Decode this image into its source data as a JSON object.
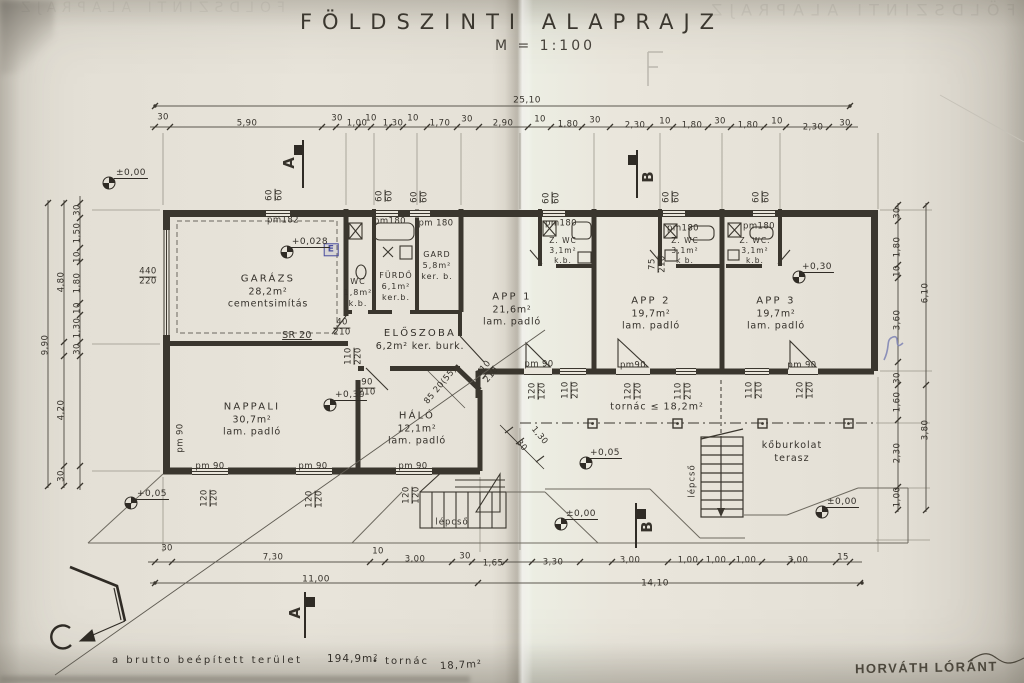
{
  "title": {
    "main": "FÖLDSZINTI ALAPRAJZ",
    "scale": "M = 1:100"
  },
  "footer": {
    "label": "a brutto beépített terület",
    "built_area": "194,9m²",
    "connector": "• tornác",
    "porch_area": "18,7m²",
    "signature": "HORVÁTH LÓRÁNT"
  },
  "rooms": [
    {
      "lines": [
        "GARÁZS",
        "28,2m²",
        "cementsimítás"
      ],
      "x": 268,
      "y": 292
    },
    {
      "lines": [
        "NAPPALI",
        "30,7m²",
        "lam. padló"
      ],
      "x": 252,
      "y": 420
    },
    {
      "lines": [
        "HÁLÓ",
        "12,1m²",
        "lam. padló"
      ],
      "x": 417,
      "y": 429
    },
    {
      "lines": [
        "ELŐSZOBA",
        "6,2m² ker. burk."
      ],
      "x": 420,
      "y": 340
    },
    {
      "lines": [
        "WC",
        "1,8m²",
        "k.b."
      ],
      "x": 358,
      "y": 293,
      "s": 8
    },
    {
      "lines": [
        "FÜRDŐ",
        "6,1m²",
        "ker.b."
      ],
      "x": 396,
      "y": 287,
      "s": 8
    },
    {
      "lines": [
        "GARD",
        "5,8m²",
        "ker. b."
      ],
      "x": 437,
      "y": 266,
      "s": 8
    },
    {
      "lines": [
        "APP 1",
        "21,6m²",
        "lam. padló"
      ],
      "x": 512,
      "y": 310
    },
    {
      "lines": [
        "APP 2",
        "19,7m²",
        "lam. padló"
      ],
      "x": 651,
      "y": 314
    },
    {
      "lines": [
        "APP 3",
        "19,7m²",
        "lam. padló"
      ],
      "x": 776,
      "y": 314
    },
    {
      "lines": [
        "Z. WC",
        "3,1m²",
        "k.b."
      ],
      "x": 563,
      "y": 251,
      "s": 7.5
    },
    {
      "lines": [
        "Z. WC",
        "3,1m²",
        "k b."
      ],
      "x": 685,
      "y": 251,
      "s": 7.5
    },
    {
      "lines": [
        "Z. WC.",
        "3,1m²",
        "k.b."
      ],
      "x": 755,
      "y": 251,
      "s": 7.5
    },
    {
      "lines": [
        "tornác ≤ 18,2m²"
      ],
      "x": 657,
      "y": 408,
      "s": 9.5
    },
    {
      "lines": [
        "kőburkolat",
        "terasz"
      ],
      "x": 792,
      "y": 453,
      "s": 9.5
    },
    {
      "lines": [
        "lépcső"
      ],
      "x": 452,
      "y": 523,
      "s": 8.5
    },
    {
      "lines": [
        "lépcső"
      ],
      "x": 693,
      "y": 481,
      "s": 8.5,
      "r": -90
    }
  ],
  "levels": [
    {
      "t": "±0,00",
      "cx": 109,
      "cy": 183,
      "tx": 131,
      "ty": 179
    },
    {
      "t": "+0,028",
      "cx": 287,
      "cy": 252,
      "tx": 310,
      "ty": 248
    },
    {
      "t": "+0,30",
      "cx": 330,
      "cy": 405,
      "tx": 350,
      "ty": 401
    },
    {
      "t": "+0,30",
      "cx": 799,
      "cy": 277,
      "tx": 817,
      "ty": 273
    },
    {
      "t": "+0,05",
      "cx": 586,
      "cy": 463,
      "tx": 605,
      "ty": 459
    },
    {
      "t": "±0,00",
      "cx": 561,
      "cy": 524,
      "tx": 581,
      "ty": 520
    },
    {
      "t": "±0,00",
      "cx": 822,
      "cy": 512,
      "tx": 842,
      "ty": 508
    },
    {
      "t": "+0,05",
      "cx": 131,
      "cy": 503,
      "tx": 152,
      "ty": 500
    }
  ],
  "labels": [
    {
      "t": "30",
      "x": 163,
      "y": 118
    },
    {
      "t": "5,90",
      "x": 247,
      "y": 124
    },
    {
      "t": "30",
      "x": 337,
      "y": 119
    },
    {
      "t": "1,00",
      "x": 357,
      "y": 124
    },
    {
      "t": "10",
      "x": 371,
      "y": 119
    },
    {
      "t": "1,30",
      "x": 393,
      "y": 124
    },
    {
      "t": "10",
      "x": 413,
      "y": 119
    },
    {
      "t": "1,70",
      "x": 440,
      "y": 124
    },
    {
      "t": "30",
      "x": 467,
      "y": 120
    },
    {
      "t": "2,90",
      "x": 503,
      "y": 124
    },
    {
      "t": "10",
      "x": 540,
      "y": 120
    },
    {
      "t": "1,80",
      "x": 568,
      "y": 125
    },
    {
      "t": "30",
      "x": 595,
      "y": 121
    },
    {
      "t": "2,30",
      "x": 635,
      "y": 126
    },
    {
      "t": "10",
      "x": 665,
      "y": 122
    },
    {
      "t": "1,80",
      "x": 692,
      "y": 126
    },
    {
      "t": "30",
      "x": 720,
      "y": 122
    },
    {
      "t": "1,80",
      "x": 748,
      "y": 126
    },
    {
      "t": "10",
      "x": 777,
      "y": 122
    },
    {
      "t": "2,30",
      "x": 813,
      "y": 128
    },
    {
      "t": "30",
      "x": 845,
      "y": 124
    },
    {
      "t": "25,10",
      "x": 527,
      "y": 101,
      "s": 9
    },
    {
      "t": "30",
      "x": 167,
      "y": 549
    },
    {
      "t": "7,30",
      "x": 273,
      "y": 558
    },
    {
      "t": "10",
      "x": 378,
      "y": 552
    },
    {
      "t": "3,00",
      "x": 415,
      "y": 560
    },
    {
      "t": "30",
      "x": 465,
      "y": 557
    },
    {
      "t": "1,65",
      "x": 493,
      "y": 564
    },
    {
      "t": "3,30",
      "x": 553,
      "y": 563
    },
    {
      "t": "3,00",
      "x": 630,
      "y": 561
    },
    {
      "t": "1,00",
      "x": 688,
      "y": 561
    },
    {
      "t": "1,00",
      "x": 716,
      "y": 561
    },
    {
      "t": "1,00",
      "x": 746,
      "y": 561
    },
    {
      "t": "3,00",
      "x": 798,
      "y": 561
    },
    {
      "t": "15",
      "x": 843,
      "y": 558
    },
    {
      "t": "11,00",
      "x": 316,
      "y": 580,
      "s": 9
    },
    {
      "t": "14,10",
      "x": 655,
      "y": 584,
      "s": 9
    },
    {
      "t": "30",
      "x": 78,
      "y": 210,
      "r": -90
    },
    {
      "t": "1,50",
      "x": 78,
      "y": 233,
      "r": -90
    },
    {
      "t": "10",
      "x": 78,
      "y": 257,
      "r": -90
    },
    {
      "t": "1,80",
      "x": 78,
      "y": 283,
      "r": -90
    },
    {
      "t": "10",
      "x": 78,
      "y": 308,
      "r": -90
    },
    {
      "t": "1,30",
      "x": 78,
      "y": 328,
      "r": -90
    },
    {
      "t": "30",
      "x": 78,
      "y": 349,
      "r": -90
    },
    {
      "t": "4,80",
      "x": 62,
      "y": 282,
      "r": -90
    },
    {
      "t": "4,20",
      "x": 62,
      "y": 410,
      "r": -90
    },
    {
      "t": "30",
      "x": 62,
      "y": 476,
      "r": -90
    },
    {
      "t": "9,90",
      "x": 46,
      "y": 345,
      "r": -90
    },
    {
      "t": "30",
      "x": 898,
      "y": 213,
      "r": -90
    },
    {
      "t": "1,80",
      "x": 898,
      "y": 247,
      "r": -90
    },
    {
      "t": "10",
      "x": 898,
      "y": 271,
      "r": -90
    },
    {
      "t": "3,60",
      "x": 898,
      "y": 320,
      "r": -90
    },
    {
      "t": "30",
      "x": 898,
      "y": 378,
      "r": -90
    },
    {
      "t": "1,60",
      "x": 898,
      "y": 402,
      "r": -90
    },
    {
      "t": "2,30",
      "x": 898,
      "y": 453,
      "r": -90
    },
    {
      "t": "1,00",
      "x": 898,
      "y": 497,
      "r": -90
    },
    {
      "t": "6,10",
      "x": 926,
      "y": 293,
      "r": -90
    },
    {
      "t": "3,80",
      "x": 926,
      "y": 430,
      "r": -90
    },
    {
      "t": "pm182",
      "x": 283,
      "y": 221
    },
    {
      "t": "pm180",
      "x": 390,
      "y": 222
    },
    {
      "t": "pm 180",
      "x": 436,
      "y": 224
    },
    {
      "t": "pm180",
      "x": 561,
      "y": 224
    },
    {
      "t": "pm180",
      "x": 683,
      "y": 229
    },
    {
      "t": "pm180",
      "x": 759,
      "y": 227
    },
    {
      "t": "pm 90",
      "x": 210,
      "y": 467
    },
    {
      "t": "pm 90",
      "x": 313,
      "y": 467
    },
    {
      "t": "pm 90",
      "x": 413,
      "y": 467
    },
    {
      "t": "pm 90",
      "x": 539,
      "y": 365
    },
    {
      "t": "pm90",
      "x": 633,
      "y": 366
    },
    {
      "t": "pm 90",
      "x": 802,
      "y": 366
    },
    {
      "t": "pm 90",
      "x": 181,
      "y": 438,
      "r": -90
    },
    {
      "t": "440/220",
      "x": 148,
      "y": 277,
      "fr": 1
    },
    {
      "t": "40/210",
      "x": 342,
      "y": 328,
      "fr": 1
    },
    {
      "t": "90/210",
      "x": 367,
      "y": 388,
      "fr": 1
    },
    {
      "t": "110/220",
      "x": 354,
      "y": 356,
      "r": -90,
      "fr": 1
    },
    {
      "t": "120/120",
      "x": 210,
      "y": 498,
      "r": -90,
      "fr": 1
    },
    {
      "t": "120/120",
      "x": 315,
      "y": 499,
      "r": -90,
      "fr": 1
    },
    {
      "t": "120/120",
      "x": 412,
      "y": 495,
      "r": -90,
      "fr": 1
    },
    {
      "t": "120/120",
      "x": 538,
      "y": 391,
      "r": -90,
      "fr": 1
    },
    {
      "t": "120/120",
      "x": 634,
      "y": 391,
      "r": -90,
      "fr": 1
    },
    {
      "t": "120/120",
      "x": 806,
      "y": 390,
      "r": -90,
      "fr": 1
    },
    {
      "t": "110/210",
      "x": 571,
      "y": 390,
      "r": -90,
      "fr": 1
    },
    {
      "t": "110/210",
      "x": 684,
      "y": 391,
      "r": -90,
      "fr": 1
    },
    {
      "t": "110/210",
      "x": 755,
      "y": 390,
      "r": -90,
      "fr": 1
    },
    {
      "t": "75/210",
      "x": 658,
      "y": 264,
      "r": -90,
      "fr": 1
    },
    {
      "t": "110/210",
      "x": 488,
      "y": 372,
      "r": -50,
      "fr": 1
    },
    {
      "t": "60/60",
      "x": 275,
      "y": 195,
      "r": -90,
      "fr": 1
    },
    {
      "t": "60/60",
      "x": 385,
      "y": 196,
      "r": -90,
      "fr": 1
    },
    {
      "t": "60/60",
      "x": 420,
      "y": 197,
      "r": -90,
      "fr": 1
    },
    {
      "t": "60/60",
      "x": 552,
      "y": 198,
      "r": -90,
      "fr": 1
    },
    {
      "t": "60/60",
      "x": 672,
      "y": 197,
      "r": -90,
      "fr": 1
    },
    {
      "t": "60/60",
      "x": 762,
      "y": 197,
      "r": -90,
      "fr": 1
    },
    {
      "t": "SR 20",
      "x": 297,
      "y": 336,
      "s": 9.5,
      "c": "u"
    },
    {
      "t": "85 20(55)",
      "x": 441,
      "y": 386,
      "r": -50
    },
    {
      "t": "30",
      "x": 521,
      "y": 446,
      "r": 50
    },
    {
      "t": "1,30",
      "x": 539,
      "y": 436,
      "r": 50
    },
    {
      "t": "E",
      "x": 331,
      "y": 250,
      "c": "stamp"
    },
    {
      "t": "A",
      "x": 290,
      "y": 163,
      "r": -90,
      "c": "sec"
    },
    {
      "t": "A",
      "x": 296,
      "y": 613,
      "r": -90,
      "c": "sec"
    },
    {
      "t": "B",
      "x": 649,
      "y": 177,
      "r": -90,
      "c": "sec"
    },
    {
      "t": "B",
      "x": 648,
      "y": 527,
      "r": -90,
      "c": "sec"
    }
  ]
}
